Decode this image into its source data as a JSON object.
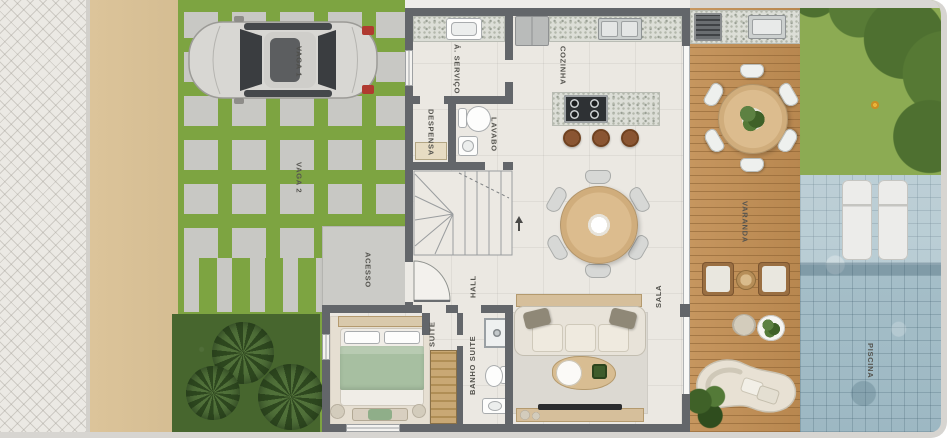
{
  "labels": {
    "vaga1": "VAGA 1",
    "vaga2": "VAGA 2",
    "acesso": "ACESSO",
    "area_servico": "Á. SERVIÇO",
    "despensa": "DESPENSA",
    "lavabo": "LAVABO",
    "cozinha": "COZINHA",
    "hall": "HALL",
    "suite": "SUITE",
    "banho_suite": "BANHO SUITE",
    "sala": "SALA",
    "varanda": "VARANDA",
    "piscina": "PISCINA"
  },
  "colors": {
    "grass": "#7da441",
    "hedge": "#47662e",
    "wall": "#63666a",
    "floor": "#ebe8e2",
    "deck_wood": "#c6965f",
    "pool": "#9db8c3",
    "sand": "#d8c095",
    "paver": "#c8c8c4",
    "sidewalk": "#ebe9e4",
    "frame": "#d7d5d1"
  }
}
